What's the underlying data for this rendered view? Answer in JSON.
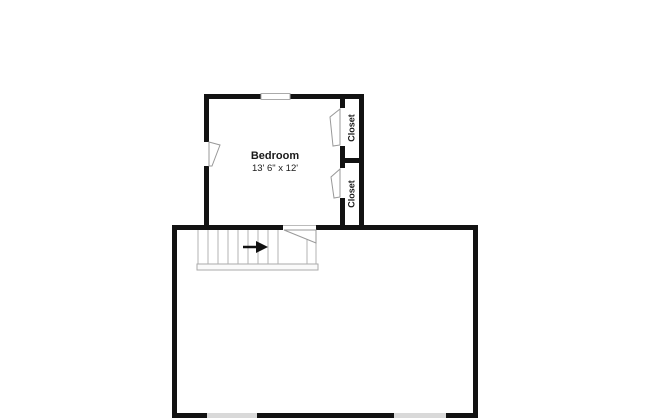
{
  "floorplan": {
    "bedroom": {
      "label": "Bedroom",
      "dimensions": "13' 6\" x 12'"
    },
    "closet_top": {
      "label": "Closet"
    },
    "closet_bottom": {
      "label": "Closet"
    },
    "colors": {
      "wall": "#121212",
      "window_fill": "#d9d9d9",
      "window_outline": "#aaaaaa",
      "door_outline": "#999999",
      "tread_line": "#b3b3b3",
      "arrow": "#111111",
      "background": "#ffffff"
    }
  }
}
